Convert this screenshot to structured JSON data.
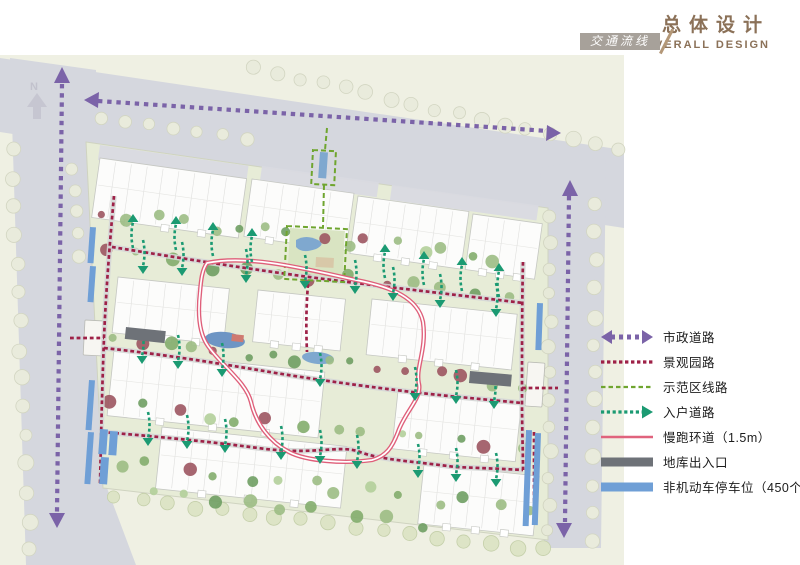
{
  "header": {
    "title_cn": "总体设计",
    "title_en": "OVERALL  DESIGN",
    "tab_label": "交通流线"
  },
  "north_label": "N",
  "legend": {
    "items": [
      {
        "label": "市政道路",
        "type": "municipal",
        "color": "#7b63a8"
      },
      {
        "label": "景观园路",
        "type": "dotted",
        "color": "#9e2147"
      },
      {
        "label": "示范区线路",
        "type": "dashed",
        "color": "#6fa52f"
      },
      {
        "label": "入户道路",
        "type": "dotted-arrow",
        "color": "#1b9a72"
      },
      {
        "label": "慢跑环道（1.5m）",
        "type": "solid",
        "color": "#e0637d"
      },
      {
        "label": "地库出入口",
        "type": "bar",
        "color": "#6e7278"
      },
      {
        "label": "非机动车停车位（450个）",
        "type": "bar",
        "color": "#6f9fd6"
      }
    ]
  },
  "map_colors": {
    "road": "#d5d7de",
    "ground": "#eff0e3",
    "site": "#e7ecd7",
    "water": "#7fa8cf",
    "building": "#fcfcfb"
  }
}
